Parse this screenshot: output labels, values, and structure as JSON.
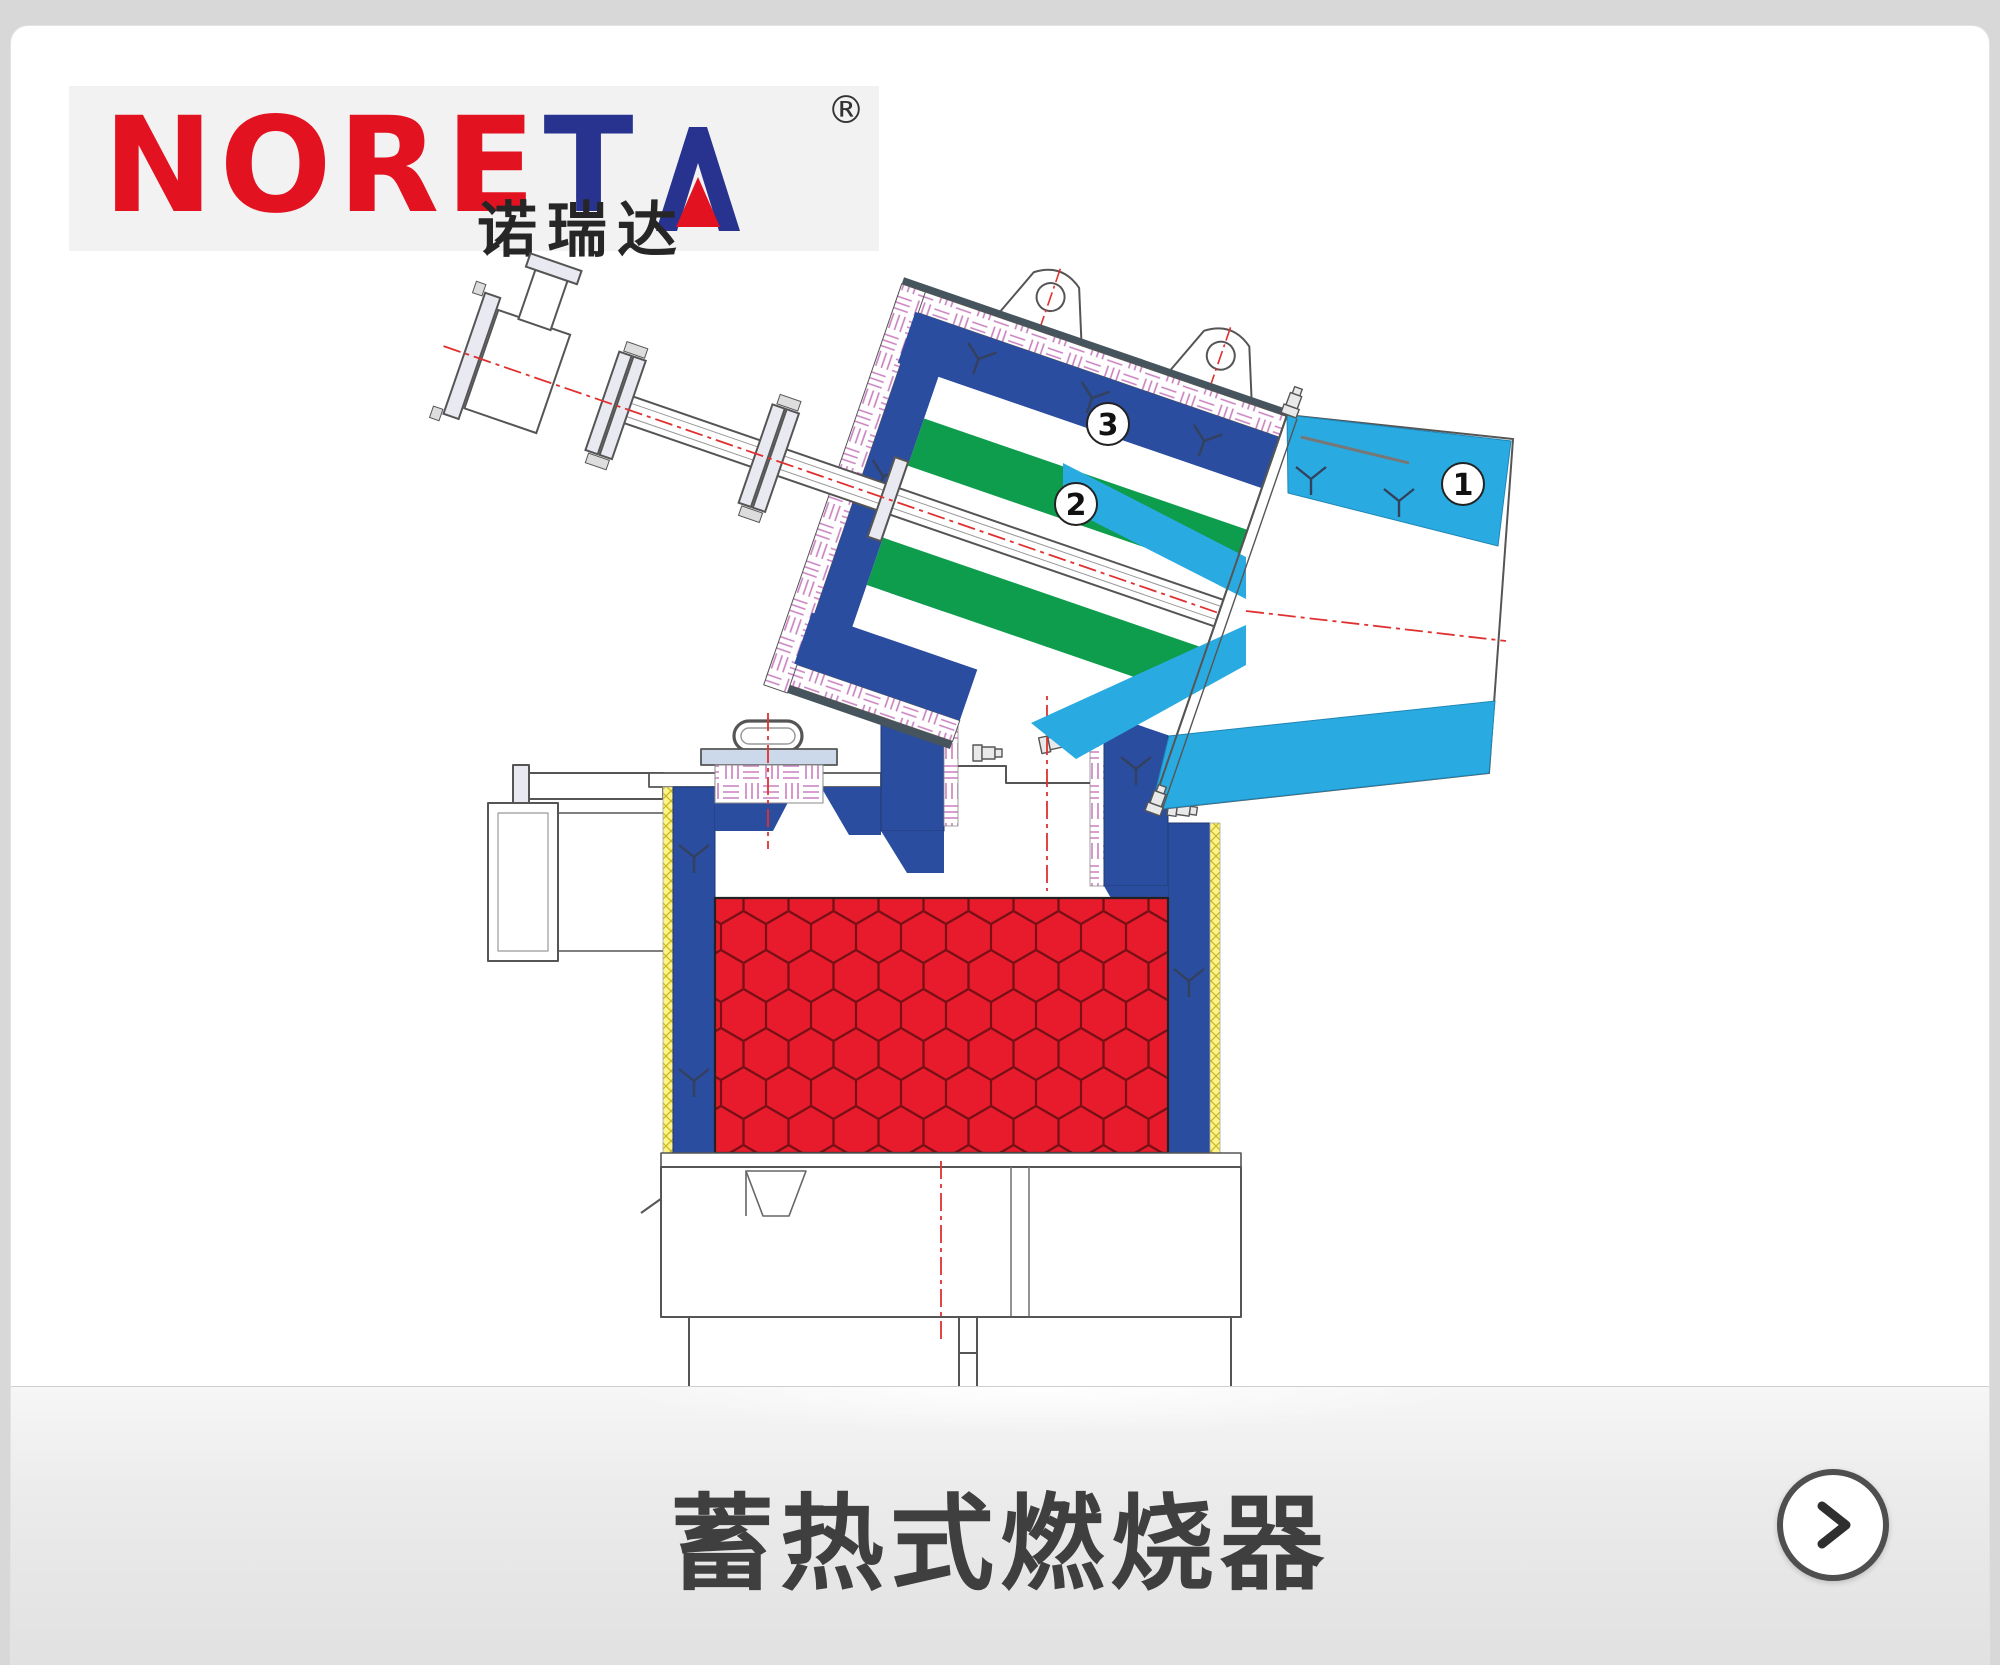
{
  "page": {
    "background_color": "#d8d8d8",
    "card_color": "#ffffff"
  },
  "logo": {
    "brand_red_part": "NORE",
    "brand_blue_part": "T",
    "brand_a_letter": "A",
    "registered_symbol": "®",
    "chinese_name": "诺瑞达",
    "colors": {
      "red": "#e31220",
      "blue": "#27338f",
      "panel_background": "#f2f2f2"
    }
  },
  "diagram": {
    "type": "technical-section-drawing",
    "part_labels": [
      {
        "number": "1"
      },
      {
        "number": "2"
      },
      {
        "number": "3"
      }
    ],
    "colors": {
      "shell_blue": "#2b4da0",
      "lance_green": "#0e9c4d",
      "nozzle_cyan": "#29abe2",
      "honeycomb_red": "#e81b2d",
      "honeycomb_line": "#7a1015",
      "insulation_hatch_pink": "#c97fc0",
      "yellow_hatch": "#fcf48a",
      "centerline_red": "#e03030",
      "outline_gray": "#555555"
    }
  },
  "footer": {
    "title": "蓄热式燃烧器"
  },
  "icons": {
    "next_button": "chevron-right-icon"
  }
}
